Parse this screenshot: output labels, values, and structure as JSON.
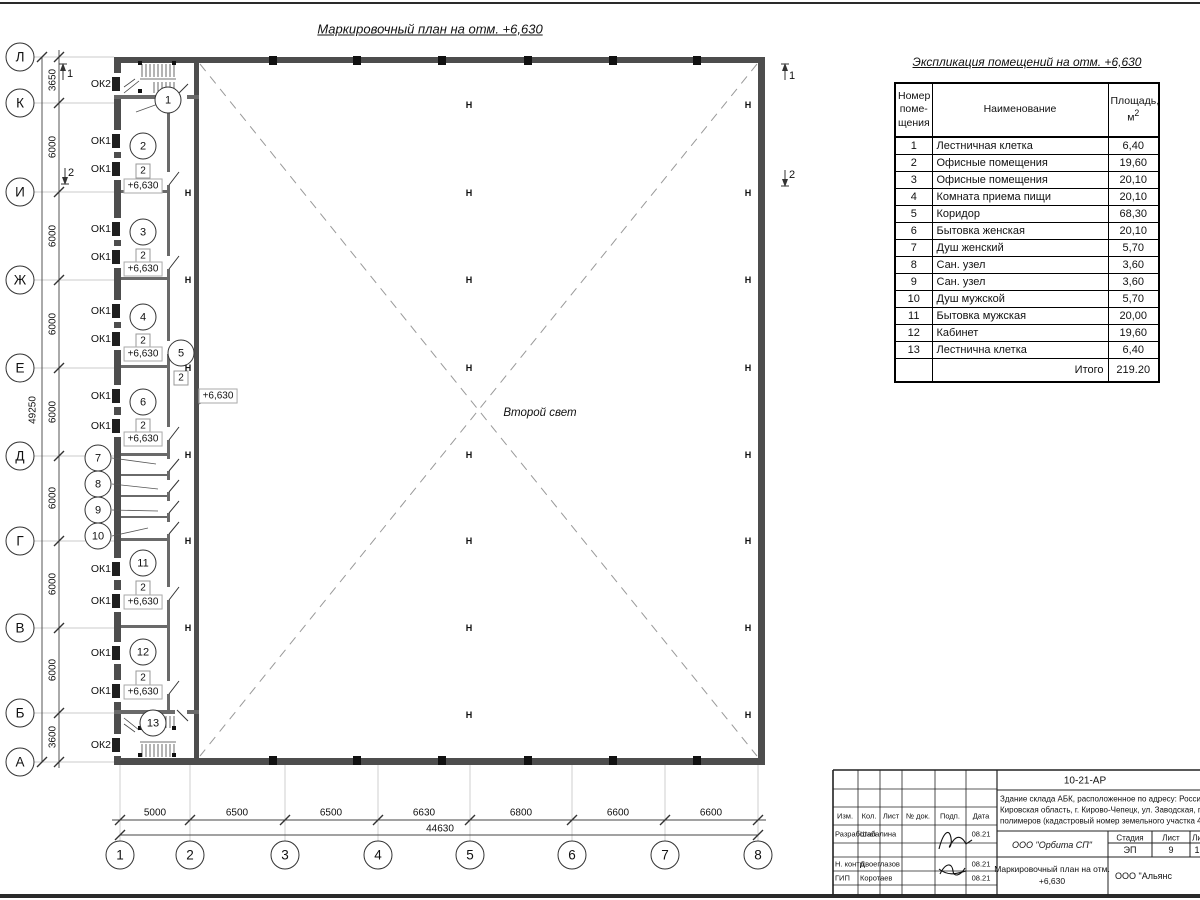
{
  "sheet": {
    "plan_title": "Маркировочный план на отм. +6,630",
    "second_light_label": "Второй свет"
  },
  "plan": {
    "axes_left": [
      {
        "t": "Л",
        "x": 20,
        "y": 57
      },
      {
        "t": "К",
        "x": 20,
        "y": 103
      },
      {
        "t": "И",
        "x": 20,
        "y": 192
      },
      {
        "t": "Ж",
        "x": 20,
        "y": 280
      },
      {
        "t": "Е",
        "x": 20,
        "y": 368
      },
      {
        "t": "Д",
        "x": 20,
        "y": 456
      },
      {
        "t": "Г",
        "x": 20,
        "y": 541
      },
      {
        "t": "В",
        "x": 20,
        "y": 628
      },
      {
        "t": "Б",
        "x": 20,
        "y": 713
      },
      {
        "t": "А",
        "x": 20,
        "y": 762
      }
    ],
    "axes_bottom": [
      {
        "t": "1",
        "x": 120,
        "y": 855
      },
      {
        "t": "2",
        "x": 190,
        "y": 855
      },
      {
        "t": "3",
        "x": 285,
        "y": 855
      },
      {
        "t": "4",
        "x": 378,
        "y": 855
      },
      {
        "t": "5",
        "x": 470,
        "y": 855
      },
      {
        "t": "6",
        "x": 572,
        "y": 855
      },
      {
        "t": "7",
        "x": 665,
        "y": 855
      },
      {
        "t": "8",
        "x": 758,
        "y": 855
      }
    ],
    "dims_left": [
      {
        "t": "3650",
        "x": 53,
        "y": 80
      },
      {
        "t": "6000",
        "x": 53,
        "y": 147
      },
      {
        "t": "6000",
        "x": 53,
        "y": 236
      },
      {
        "t": "6000",
        "x": 53,
        "y": 324
      },
      {
        "t": "6000",
        "x": 53,
        "y": 412
      },
      {
        "t": "6000",
        "x": 53,
        "y": 498
      },
      {
        "t": "6000",
        "x": 53,
        "y": 584
      },
      {
        "t": "6000",
        "x": 53,
        "y": 670
      },
      {
        "t": "3600",
        "x": 53,
        "y": 737
      }
    ],
    "dim_total_left": {
      "t": "49250",
      "x": 33,
      "y": 410
    },
    "dims_bottom": [
      {
        "t": "5000",
        "x": 155,
        "y": 813
      },
      {
        "t": "6500",
        "x": 237,
        "y": 813
      },
      {
        "t": "6500",
        "x": 331,
        "y": 813
      },
      {
        "t": "6630",
        "x": 424,
        "y": 813
      },
      {
        "t": "6800",
        "x": 521,
        "y": 813
      },
      {
        "t": "6600",
        "x": 618,
        "y": 813
      },
      {
        "t": "6600",
        "x": 711,
        "y": 813
      }
    ],
    "dim_total_bottom": {
      "t": "44630",
      "x": 440,
      "y": 829
    },
    "window_labels": [
      {
        "t": "ОК2",
        "x": 111,
        "y": 84
      },
      {
        "t": "ОК1",
        "x": 111,
        "y": 141
      },
      {
        "t": "ОК1",
        "x": 111,
        "y": 169
      },
      {
        "t": "ОК1",
        "x": 111,
        "y": 229
      },
      {
        "t": "ОК1",
        "x": 111,
        "y": 257
      },
      {
        "t": "ОК1",
        "x": 111,
        "y": 311
      },
      {
        "t": "ОК1",
        "x": 111,
        "y": 339
      },
      {
        "t": "ОК1",
        "x": 111,
        "y": 396
      },
      {
        "t": "ОК1",
        "x": 111,
        "y": 426
      },
      {
        "t": "ОК1",
        "x": 111,
        "y": 569
      },
      {
        "t": "ОК1",
        "x": 111,
        "y": 601
      },
      {
        "t": "ОК1",
        "x": 111,
        "y": 653
      },
      {
        "t": "ОК1",
        "x": 111,
        "y": 691
      },
      {
        "t": "ОК2",
        "x": 111,
        "y": 745
      }
    ],
    "room_bubbles": [
      {
        "t": "1",
        "x": 168,
        "y": 100
      },
      {
        "t": "2",
        "x": 143,
        "y": 146
      },
      {
        "t": "3",
        "x": 143,
        "y": 232
      },
      {
        "t": "4",
        "x": 143,
        "y": 317
      },
      {
        "t": "5",
        "x": 181,
        "y": 353
      },
      {
        "t": "6",
        "x": 143,
        "y": 402
      },
      {
        "t": "7",
        "x": 98,
        "y": 458
      },
      {
        "t": "8",
        "x": 98,
        "y": 484
      },
      {
        "t": "9",
        "x": 98,
        "y": 510
      },
      {
        "t": "10",
        "x": 98,
        "y": 536
      },
      {
        "t": "11",
        "x": 143,
        "y": 563
      },
      {
        "t": "12",
        "x": 143,
        "y": 652
      },
      {
        "t": "13",
        "x": 153,
        "y": 723
      }
    ],
    "floor_type_markers": [
      {
        "t": "2",
        "x": 143,
        "y": 171
      },
      {
        "t": "2",
        "x": 143,
        "y": 256
      },
      {
        "t": "2",
        "x": 143,
        "y": 341
      },
      {
        "t": "2",
        "x": 181,
        "y": 378
      },
      {
        "t": "2",
        "x": 143,
        "y": 426
      },
      {
        "t": "2",
        "x": 143,
        "y": 588
      },
      {
        "t": "2",
        "x": 143,
        "y": 678
      }
    ],
    "elevation_marks": [
      {
        "t": "+6,630",
        "x": 143,
        "y": 186
      },
      {
        "t": "+6,630",
        "x": 143,
        "y": 269
      },
      {
        "t": "+6,630",
        "x": 143,
        "y": 354
      },
      {
        "t": "+6,630",
        "x": 143,
        "y": 439
      },
      {
        "t": "+6,630",
        "x": 143,
        "y": 602
      },
      {
        "t": "+6,630",
        "x": 143,
        "y": 692
      },
      {
        "t": "+6,630",
        "x": 218,
        "y": 396
      }
    ],
    "column_marks": [
      {
        "t": "Н",
        "x": 188,
        "y": 193
      },
      {
        "t": "Н",
        "x": 188,
        "y": 280
      },
      {
        "t": "Н",
        "x": 188,
        "y": 368
      },
      {
        "t": "Н",
        "x": 188,
        "y": 455
      },
      {
        "t": "Н",
        "x": 188,
        "y": 541
      },
      {
        "t": "Н",
        "x": 188,
        "y": 628
      },
      {
        "t": "Н",
        "x": 469,
        "y": 105
      },
      {
        "t": "Н",
        "x": 469,
        "y": 193
      },
      {
        "t": "Н",
        "x": 469,
        "y": 280
      },
      {
        "t": "Н",
        "x": 469,
        "y": 368
      },
      {
        "t": "Н",
        "x": 469,
        "y": 455
      },
      {
        "t": "Н",
        "x": 469,
        "y": 541
      },
      {
        "t": "Н",
        "x": 469,
        "y": 628
      },
      {
        "t": "Н",
        "x": 469,
        "y": 715
      },
      {
        "t": "Н",
        "x": 748,
        "y": 105
      },
      {
        "t": "Н",
        "x": 748,
        "y": 193
      },
      {
        "t": "Н",
        "x": 748,
        "y": 280
      },
      {
        "t": "Н",
        "x": 748,
        "y": 368
      },
      {
        "t": "Н",
        "x": 748,
        "y": 455
      },
      {
        "t": "Н",
        "x": 748,
        "y": 541
      },
      {
        "t": "Н",
        "x": 748,
        "y": 628
      },
      {
        "t": "Н",
        "x": 748,
        "y": 715
      }
    ],
    "section_labels": [
      {
        "t": "1",
        "x": 70,
        "y": 74
      },
      {
        "t": "2",
        "x": 71,
        "y": 173
      },
      {
        "t": "1",
        "x": 792,
        "y": 76
      },
      {
        "t": "2",
        "x": 792,
        "y": 175
      }
    ]
  },
  "explication": {
    "title": "Экспликация помещений на отм. +6,630",
    "header": {
      "num_lines": [
        "Номер",
        "поме-",
        "щения"
      ],
      "name": "Наименование",
      "area_line1": "Площадь,",
      "area_unit": "м",
      "area_sup": "2"
    },
    "rows": [
      {
        "num": "1",
        "name": "Лестничная клетка",
        "area": "6,40"
      },
      {
        "num": "2",
        "name": "Офисные помещения",
        "area": "19,60"
      },
      {
        "num": "3",
        "name": "Офисные помещения",
        "area": "20,10"
      },
      {
        "num": "4",
        "name": "Комната приема пищи",
        "area": "20,10"
      },
      {
        "num": "5",
        "name": "Коридор",
        "area": "68,30"
      },
      {
        "num": "6",
        "name": "Бытовка женская",
        "area": "20,10"
      },
      {
        "num": "7",
        "name": "Душ женский",
        "area": "5,70"
      },
      {
        "num": "8",
        "name": "Сан. узел",
        "area": "3,60"
      },
      {
        "num": "9",
        "name": "Сан. узел",
        "area": "3,60"
      },
      {
        "num": "10",
        "name": "Душ мужской",
        "area": "5,70"
      },
      {
        "num": "11",
        "name": "Бытовка мужская",
        "area": "20,00"
      },
      {
        "num": "12",
        "name": "Кабинет",
        "area": "19,60"
      },
      {
        "num": "13",
        "name": "Лестнична клетка",
        "area": "6,40"
      }
    ],
    "total_label": "Итого",
    "total_value": "219.20"
  },
  "title_block": {
    "doc_number": "10-21-АР",
    "address_lines": [
      {
        "t": "Здание склада АБК, расположенное по адресу: Российская Феде",
        "x": 1000,
        "y": 799
      },
      {
        "t": "Кировская область, г. Кирово-Чепецк, ул. Заводская, площадка з",
        "x": 1000,
        "y": 810
      },
      {
        "t": "полимеров (кадастровый номер земельного участка 43:42:0000",
        "x": 1000,
        "y": 821
      }
    ],
    "columns": [
      {
        "t": "Изм.",
        "x": 845,
        "y": 816
      },
      {
        "t": "Кол.",
        "x": 869,
        "y": 816
      },
      {
        "t": "Лист",
        "x": 891,
        "y": 816
      },
      {
        "t": "№ док.",
        "x": 918,
        "y": 816
      },
      {
        "t": "Подп.",
        "x": 950,
        "y": 816
      },
      {
        "t": "Дата",
        "x": 981,
        "y": 816
      }
    ],
    "people": [
      {
        "role": "Разработал",
        "name": "Шабалина",
        "date": "08.21",
        "y": 834
      },
      {
        "role": "Н. контр.",
        "name": "Двоеглазов",
        "date": "08.21",
        "y": 864
      },
      {
        "role": "ГИП",
        "name": "Коротаев",
        "date": "08.21",
        "y": 878
      }
    ],
    "org": "ООО \"Орбита СП\"",
    "stage_label": "Стадия",
    "sheet_label": "Лист",
    "sheets_label": "Ли",
    "stage_value": "ЭП",
    "sheet_value": "9",
    "sheets_value": "1",
    "plan_name_line1": "Маркировочный план на отм.",
    "plan_name_line2": "+6,630",
    "org2": "ООО \"Альянс"
  }
}
